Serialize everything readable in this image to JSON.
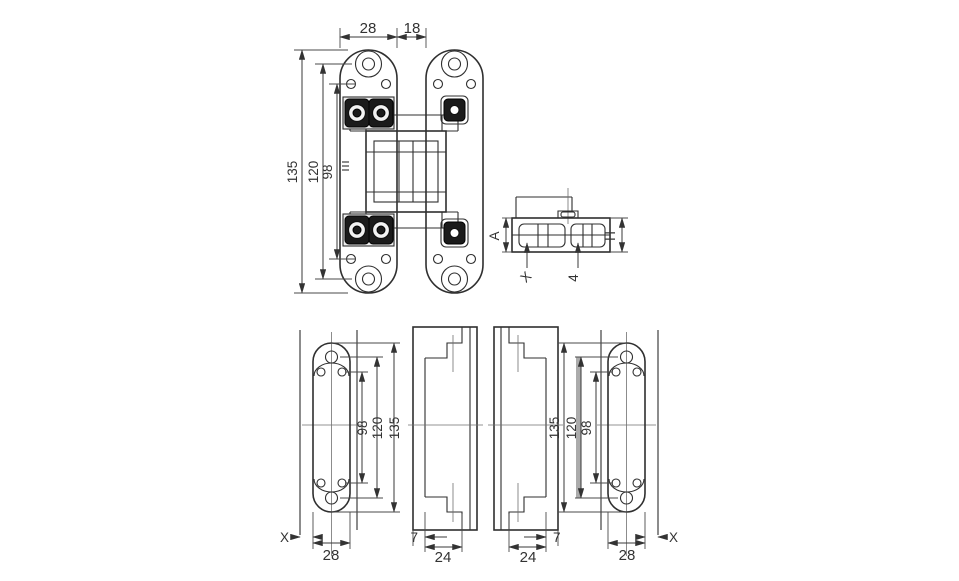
{
  "colors": {
    "background": "#ffffff",
    "line": "#2f2f2f",
    "dimension": "#3a3a3a",
    "highlight_gray": "#9c9c9c"
  },
  "views": {
    "front": {
      "dim_plate_width": "28",
      "dim_gap": "18",
      "dim_total_height": "135",
      "dim_outer_span": "120",
      "dim_inner_span": "98"
    },
    "top_section": {
      "dim_left": "A",
      "dim_right": "H",
      "leader_left": "X",
      "leader_right": "4"
    },
    "plate_left": {
      "dim_inner": "98",
      "dim_mid": "120",
      "dim_outer": "135",
      "dim_width": "28",
      "dim_offset": "X"
    },
    "jamb_left": {
      "dim_lip": "7",
      "dim_width": "24"
    },
    "jamb_right": {
      "dim_lip": "7",
      "dim_width": "24"
    },
    "plate_right": {
      "dim_outer": "135",
      "dim_mid": "120",
      "dim_inner": "98",
      "dim_width": "28",
      "dim_offset": "X"
    }
  }
}
